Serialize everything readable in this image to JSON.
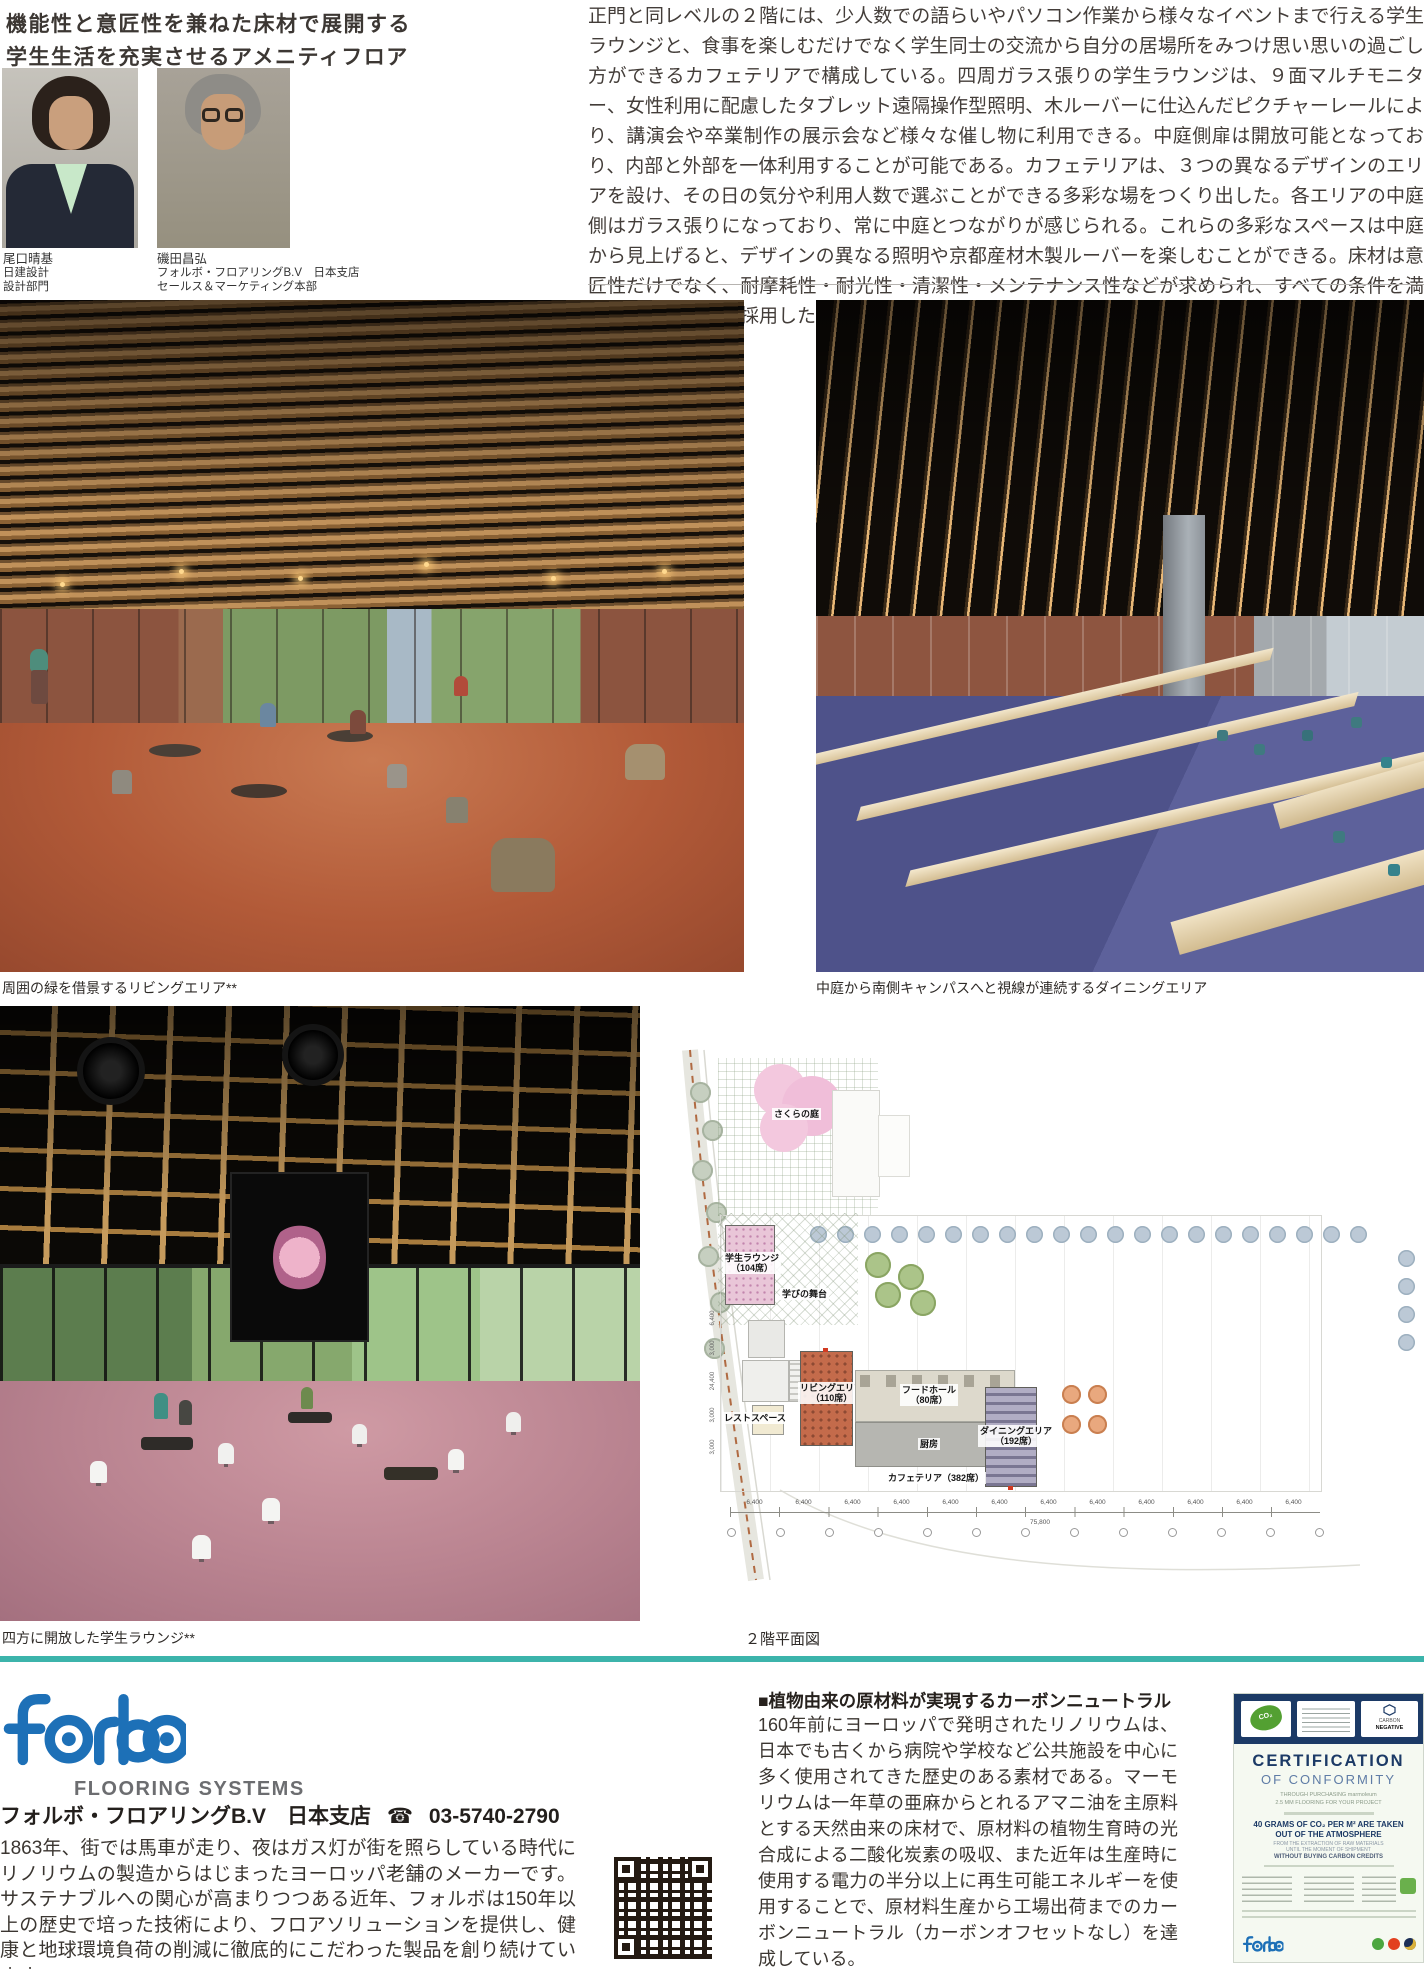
{
  "header": {
    "headline1": "機能性と意匠性を兼ねた床材で展開する",
    "headline2": "学生生活を充実させるアメニティフロア",
    "people": [
      {
        "name": "尾口晴基",
        "org1": "日建設計",
        "org2": "設計部門"
      },
      {
        "name": "磯田昌弘",
        "org1": "フォルボ・フロアリングB.V　日本支店",
        "org2": "セールス＆マーケティング本部"
      }
    ],
    "intro": "正門と同レベルの２階には、少人数での語らいやパソコン作業から様々なイベントまで行える学生ラウンジと、食事を楽しむだけでなく学生同士の交流から自分の居場所をみつけ思い思いの過ごし方ができるカフェテリアで構成している。四周ガラス張りの学生ラウンジは、９面マルチモニター、女性利用に配慮したタブレット遠隔操作型照明、木ルーバーに仕込んだピクチャーレールにより、講演会や卒業制作の展示会など様々な催し物に利用できる。中庭側扉は開放可能となっており、内部と外部を一体利用することが可能である。カフェテリアは、３つの異なるデザインのエリアを設け、その日の気分や利用人数で選ぶことができる多彩な場をつくり出した。各エリアの中庭側はガラス張りになっており、常に中庭とつながりが感じられる。これらの多彩なスペースは中庭から見上げると、デザインの異なる照明や京都産材木製ルーバーを楽しむことができる。床材は意匠性だけでなく、耐摩耗性・耐光性・清潔性・メンテナンス性などが求められ、すべての条件を満たすリノリウムを採用した。"
  },
  "photos": [
    {
      "caption": "周囲の緑を借景するリビングエリア**"
    },
    {
      "caption": "中庭から南側キャンパスへと視線が連続するダイニングエリア"
    },
    {
      "caption": "四方に開放した学生ラウンジ**"
    }
  ],
  "plan": {
    "caption": "２階平面図",
    "labels": {
      "sakura": "さくらの庭",
      "lounge1": "学生ラウンジ",
      "lounge2": "（104席）",
      "stage": "学びの舞台",
      "rest": "レストスペース",
      "living1": "リビングエリア",
      "living2": "（110席）",
      "food1": "フードホール",
      "food2": "（80席）",
      "kitchen": "厨房",
      "dining1": "ダイニングエリア",
      "dining2": "（192席）",
      "cafeteria": "カフェテリア（382席）"
    },
    "dims": {
      "seg": "6,400",
      "total": "75,800",
      "left": [
        "6,400",
        "3,000",
        "24,400",
        "3,000",
        "3,000"
      ]
    }
  },
  "footer": {
    "brand": {
      "tagline": "FLOORING SYSTEMS",
      "company": "フォルボ・フロアリングB.V　日本支店",
      "phone_icon": "☎",
      "phone": "03-5740-2790"
    },
    "company_text": "1863年、街では馬車が走り、夜はガス灯が街を照らしている時代にリノリウムの製造からはじまったヨーロッパ老舗のメーカーです。サステナブルへの関心が高まりつつある近年、フォルボは150年以上の歴史で培った技術により、フロアソリューションを提供し、健康と地球環境負荷の削減に徹底的にこだわった製品を創り続けています。",
    "article": {
      "heading": "■植物由来の原材料が実現するカーボンニュートラル",
      "body": "160年前にヨーロッパで発明されたリノリウムは、日本でも古くから病院や学校など公共施設を中心に多く使用されてきた歴史のある素材である。マーモリウムは一年草の亜麻からとれるアマニ油を主原料とする天然由来の床材で、原材料の植物生育時の光合成による二酸化炭素の吸収、また近年は生産時に使用する電力の半分以上に再生可能エネルギーを使用することで、原材料生産から工場出荷までのカーボンニュートラル（カーボンオフセットなし）を達成している。"
    },
    "cert": {
      "title1": "CERTIFICATION",
      "title2": "OF CONFORMITY",
      "sub1": "THROUGH PURCHASING marmoleum",
      "sub2": "2.5 MM FLOORING FOR YOUR PROJECT",
      "claim1": "40 GRAMS OF CO₂ PER M² ARE TAKEN",
      "claim2": "OUT OF THE ATMOSPHERE",
      "d1": "FROM THE EXTRACTION OF RAW MATERIALS",
      "d2": "UNTIL THE MOMENT OF SHIPMENT",
      "d3": "WITHOUT BUYING CARBON CREDITS",
      "badge1": "CARBON",
      "badge2": "NEGATIVE",
      "leaf": "CO₂"
    }
  },
  "colors": {
    "brand_blue": "#1d70b7",
    "divider_teal": "#3cb4ab",
    "cert_navy": "#1c3a66"
  }
}
